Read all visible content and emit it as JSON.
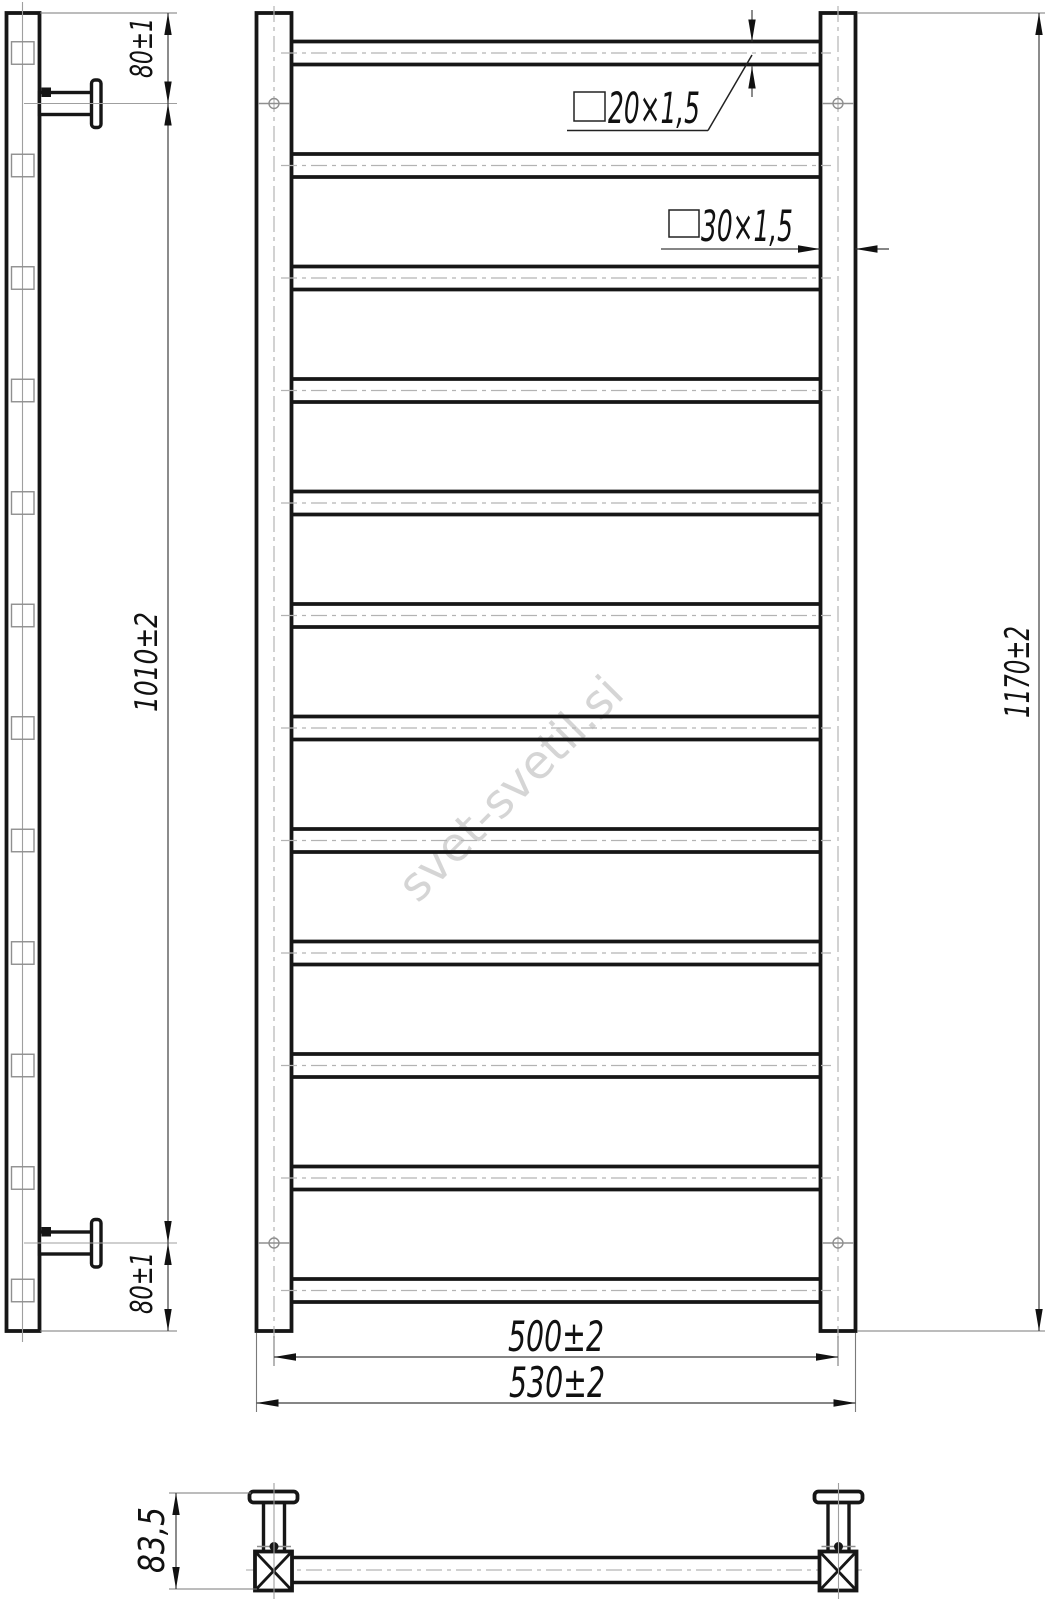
{
  "drawing": {
    "watermark": "svet-svetil.si",
    "rungs": {
      "count": 12
    },
    "dimensions": {
      "rung_tube": "20×1,5",
      "post_tube": "30×1,5",
      "bracket_top_offset": "80±1",
      "bracket_span": "1010±2",
      "bracket_bottom_offset": "80±1",
      "height_overall": "1170±2",
      "width_centers": "500±2",
      "width_overall": "530±2",
      "depth": "83,5"
    }
  }
}
